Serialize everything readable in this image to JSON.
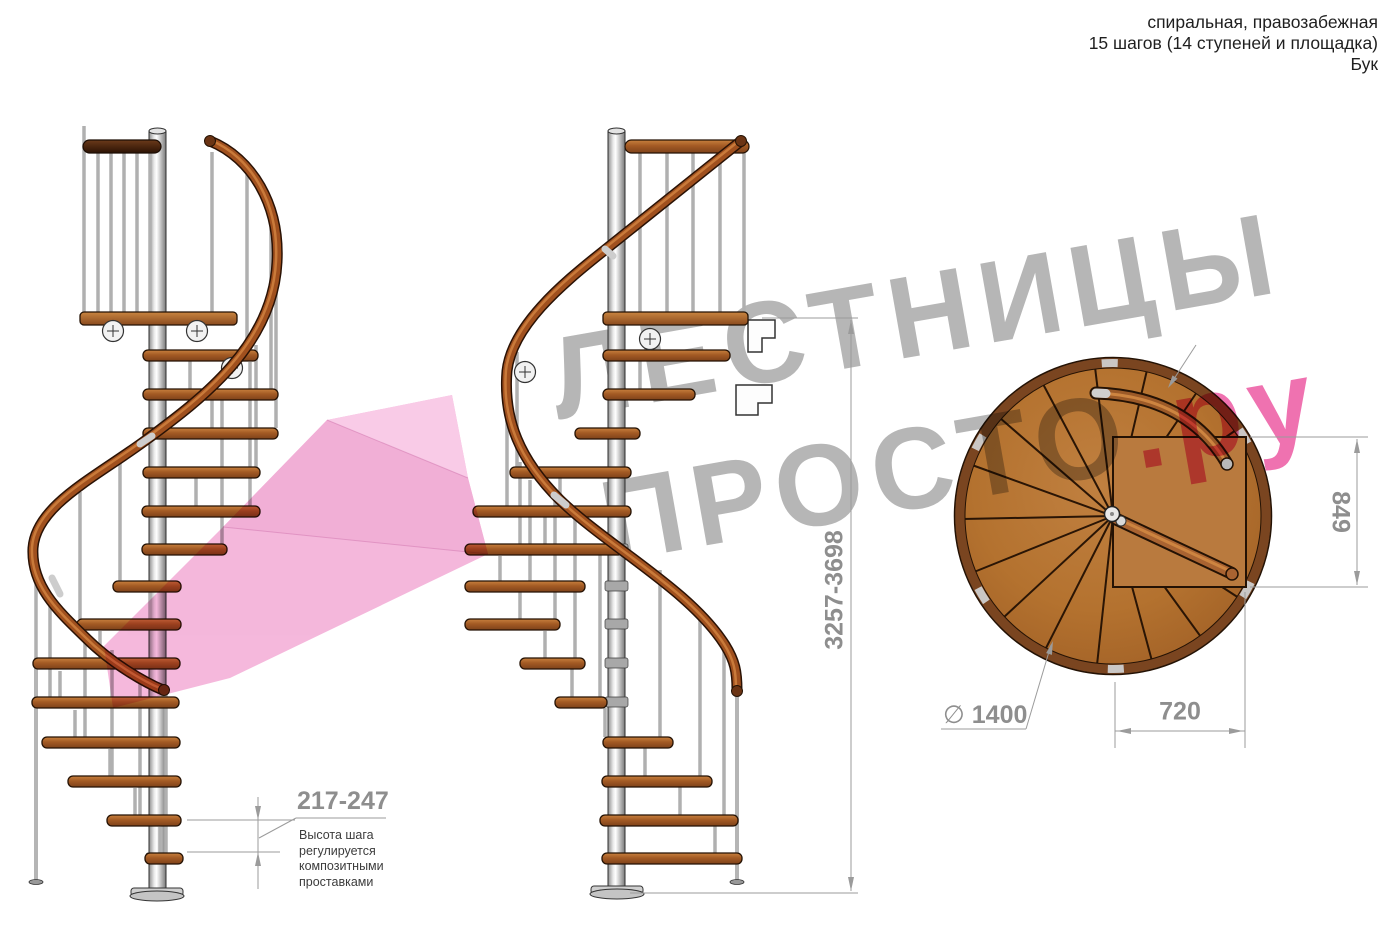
{
  "header": {
    "line1": "спиральная, правозабежная",
    "line2": "15 шагов (14 ступеней и площадка)",
    "line3": "Бук"
  },
  "watermark": {
    "line1": "ЛЕСТНИЦЫ",
    "line2_main": "ПРОСТО",
    "line2_suffix": ".ру"
  },
  "dimensions": {
    "total_height": "3257-3698",
    "step_height": "217-247",
    "step_note_lines": [
      "Высота шага",
      "регулируется",
      "композитными",
      "проставками"
    ],
    "plan_width": "849",
    "plan_depth": "720",
    "diameter_symbol": "∅",
    "diameter_value": "1400"
  },
  "drawing": {
    "views": [
      "боковой вид 1",
      "боковой вид 2",
      "вид сверху"
    ],
    "steps_total": 15,
    "treads": 14,
    "has_platform": true
  },
  "colors": {
    "wood": "#a65c28",
    "handrail": "#8a4a1e",
    "pole_silver": "#d8d8d8",
    "watermark_gray": "#b6b6b6",
    "watermark_pink": "#ef72b0",
    "arrow_pink": "#f4b4da",
    "dimension_gray": "#8e8e8e"
  }
}
